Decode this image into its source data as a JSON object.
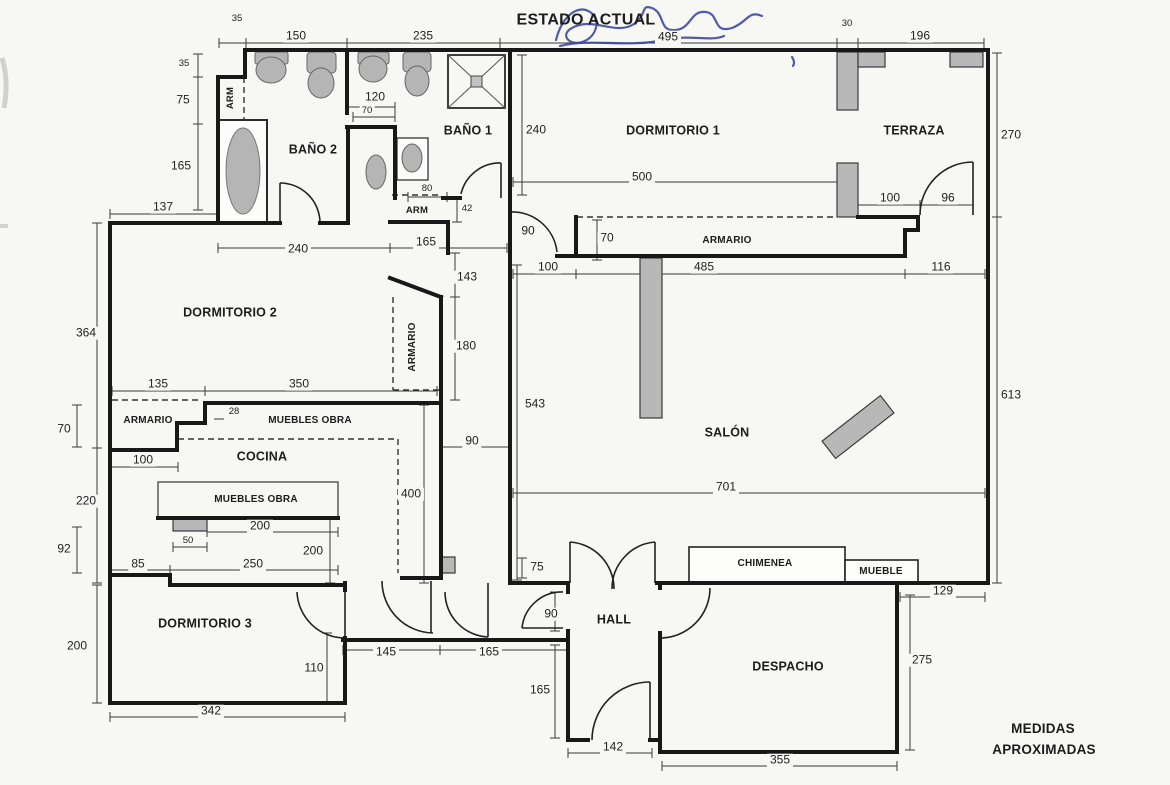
{
  "title": "ESTADO ACTUAL",
  "note": {
    "line1": "MEDIDAS",
    "line2": "APROXIMADAS"
  },
  "colors": {
    "wall": "#181818",
    "fixture_fill": "#b5b5b5",
    "handwriting_ink": "#35409b",
    "paper": "#f7f7f4"
  },
  "rooms": {
    "bano2": "BAÑO 2",
    "bano1": "BAÑO 1",
    "dormitorio1": "DORMITORIO 1",
    "terraza": "TERRAZA",
    "dormitorio2": "DORMITORIO 2",
    "cocina": "COCINA",
    "dormitorio3": "DORMITORIO 3",
    "salon": "SALÓN",
    "hall": "HALL",
    "despacho": "DESPACHO"
  },
  "features": {
    "armario_dorm1": "ARMARIO",
    "armario_dorm2": "ARMARIO",
    "armario_pasillo": "ARMARIO",
    "muebles_obra_1": "MUEBLES OBRA",
    "muebles_obra_2": "MUEBLES OBRA",
    "chimenea": "CHIMENEA",
    "mueble": "MUEBLE",
    "arm_bano2": "ARM",
    "arm_bano1": "ARM"
  },
  "dims": {
    "top_35": "35",
    "top_150": "150",
    "top_235": "235",
    "top_495": "495",
    "top_30": "30",
    "top_196": "196",
    "right_270": "270",
    "right_613": "613",
    "left_35": "35",
    "left_75": "75",
    "left_165": "165",
    "left_137": "137",
    "left_364": "364",
    "left_70": "70",
    "left_220": "220",
    "left_92": "92",
    "left_85": "85",
    "left_100": "100",
    "left_200": "200",
    "bottom_342": "342",
    "dorm2_135": "135",
    "dorm2_350": "350",
    "dorm2_28": "28",
    "muebles_200": "200",
    "muebles_50": "50",
    "muebles_250": "250",
    "muebles_200v": "200",
    "cocina_400": "400",
    "pasillo_90": "90",
    "pasillo_143": "143",
    "pasillo_180": "180",
    "bano2_120": "120",
    "bano2_70": "70",
    "bano2_240": "240",
    "bano2_165": "165",
    "arm_80": "80",
    "arm_42": "42",
    "dorm1_240": "240",
    "dorm1_500": "500",
    "dorm1_90": "90",
    "dorm1_70": "70",
    "dorm1_100": "100",
    "dorm1_485": "485",
    "dorm1_116": "116",
    "terraza_100": "100",
    "terraza_96": "96",
    "salon_543": "543",
    "salon_701": "701",
    "hall_75": "75",
    "hall_90": "90",
    "hall_165": "165",
    "hall_142": "142",
    "dorm3_110": "110",
    "dorm3_145": "145",
    "dorm3_165": "165",
    "despacho_355": "355",
    "despacho_275": "275",
    "despacho_129": "129"
  }
}
